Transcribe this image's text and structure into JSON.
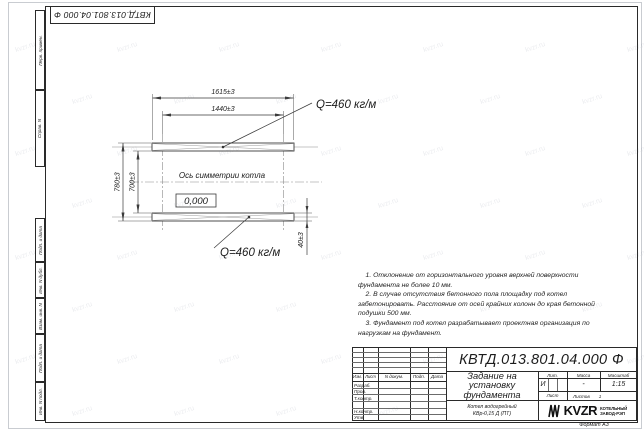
{
  "sheet": {
    "doc_number_top": "КВТД.013.801.04.000 Ф",
    "format_label": "Формат А3",
    "watermark_text": "kvzr.ru"
  },
  "frame_labels": {
    "perv_primen": "Перв. примен.",
    "sprav_n": "Справ. N",
    "podp_data_1": "Подп. и дата",
    "inv_dubl": "Инв. N дубл.",
    "vzam_inv": "Взам. инв. N",
    "podp_data_2": "Подп. и дата",
    "inv_podl": "Инв. N подл."
  },
  "drawing": {
    "dim_length_outer": "1615±3",
    "dim_length_inner": "1440±3",
    "dim_width_outer": "780±3",
    "dim_width_inner": "700±3",
    "dim_beam_height": "40±3",
    "load_label_top": "Q=460 кг/м",
    "load_label_bottom": "Q=460 кг/м",
    "axis_label": "Ось симметрии котла",
    "elevation_mark": "0,000"
  },
  "notes": {
    "lines": [
      "    1. Отклонение от горизонтального уровня верхней поверхности",
      "фундамента не более 10 мм.",
      "    2. В случае отсутствия бетонного пола площадку под котел",
      "забетонировать. Расстояние от осей крайних колонн до края бетонной",
      "подушки 500 мм.",
      "    3. Фундамент под котел разрабатывает проектная организация по",
      "нагрузкам на фундамент."
    ]
  },
  "title_block": {
    "doc_number": "КВТД.013.801.04.000 Ф",
    "title": "Задание на установку фундамента",
    "product_line1": "Котел водогрейный",
    "product_line2": "КВр-0,15 Д (ПТ)",
    "col_izm": "Изм.",
    "col_list": "Лист",
    "col_n_dokum": "N докум.",
    "col_podp": "Подп.",
    "col_data": "Дата",
    "row_razrab": "Разраб.",
    "row_prov": "Пров.",
    "row_t_kontr": "Т.контр.",
    "row_n_kontr": "Н.контр.",
    "row_utv": "Утв.",
    "lit_label": "Лит.",
    "massa_label": "Масса",
    "masshtab_label": "Масштаб",
    "lit_value": "И",
    "massa_value": "-",
    "masshtab_value": "1:15",
    "list_label": "Лист",
    "listov_label": "Листов",
    "listov_value": "1",
    "logo_text": "KVZR",
    "logo_sub1": "КОТЕЛЬНЫЙ",
    "logo_sub2": "ЗАВОД-РЭП"
  }
}
